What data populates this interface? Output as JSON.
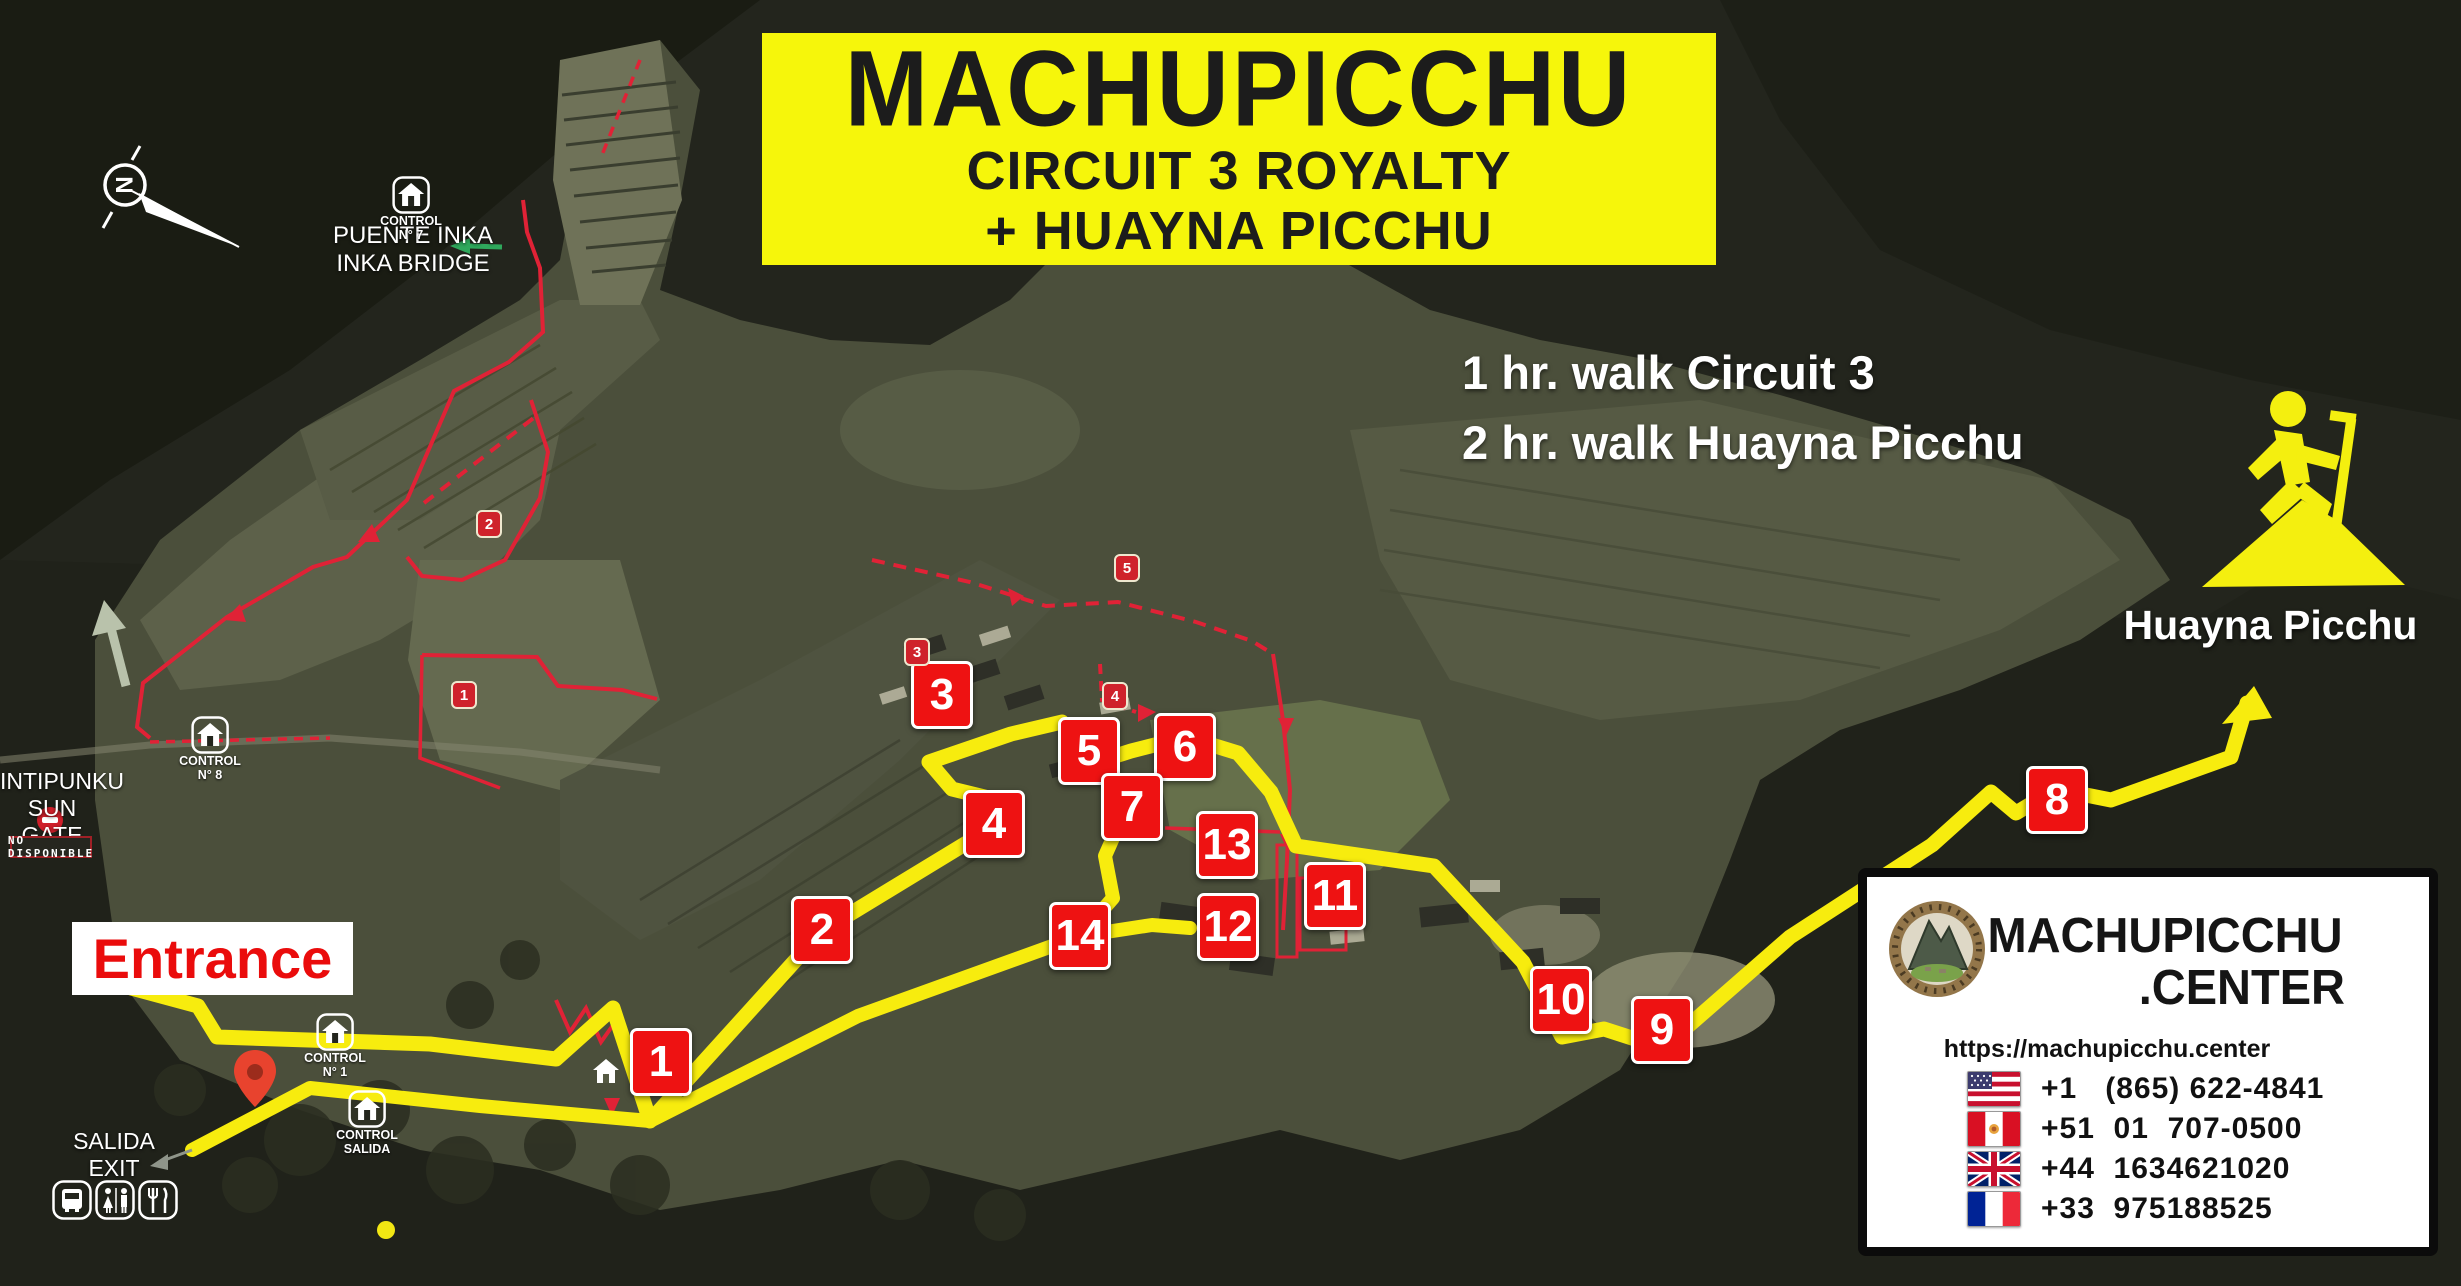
{
  "banner": {
    "title": "MACHUPICCHU",
    "subtitle1": "CIRCUIT 3 ROYALTY",
    "subtitle2": "+ HUAYNA PICCHU"
  },
  "walk_info": {
    "line1": "1 hr. walk Circuit 3",
    "line2": "2 hr. walk Huayna Picchu"
  },
  "huayna": {
    "label": "Huayna Picchu"
  },
  "entrance": {
    "label": "Entrance"
  },
  "exit_label": {
    "line1": "SALIDA",
    "line2": "EXIT"
  },
  "sun_gate": {
    "line1": "INTIPUNKU",
    "line2": "SUN GATE",
    "badge": "NO DISPONIBLE"
  },
  "inka_bridge": {
    "line1": "PUENTE INKA",
    "line2": "INKA BRIDGE"
  },
  "compass": {
    "letter": "N"
  },
  "controls": [
    {
      "id": "7",
      "line1": "CONTROL",
      "line2": "N° 7",
      "x": 411,
      "y": 176
    },
    {
      "id": "8",
      "line1": "CONTROL",
      "line2": "N° 8",
      "x": 210,
      "y": 716
    },
    {
      "id": "1",
      "line1": "CONTROL",
      "line2": "N° 1",
      "x": 335,
      "y": 1013
    },
    {
      "id": "salida",
      "line1": "CONTROL",
      "line2": "SALIDA",
      "x": 367,
      "y": 1090
    }
  ],
  "waypoints": [
    {
      "n": "1",
      "x": 661,
      "y": 1062
    },
    {
      "n": "2",
      "x": 822,
      "y": 930
    },
    {
      "n": "3",
      "x": 942,
      "y": 695
    },
    {
      "n": "4",
      "x": 994,
      "y": 824
    },
    {
      "n": "5",
      "x": 1089,
      "y": 751
    },
    {
      "n": "6",
      "x": 1185,
      "y": 747
    },
    {
      "n": "7",
      "x": 1132,
      "y": 807
    },
    {
      "n": "8",
      "x": 2057,
      "y": 800
    },
    {
      "n": "9",
      "x": 1662,
      "y": 1030
    },
    {
      "n": "10",
      "x": 1561,
      "y": 1000
    },
    {
      "n": "11",
      "x": 1335,
      "y": 896
    },
    {
      "n": "12",
      "x": 1228,
      "y": 927
    },
    {
      "n": "13",
      "x": 1227,
      "y": 845
    },
    {
      "n": "14",
      "x": 1080,
      "y": 936
    }
  ],
  "red_waypoints": [
    {
      "n": "1",
      "x": 464,
      "y": 695
    },
    {
      "n": "2",
      "x": 489,
      "y": 524
    },
    {
      "n": "3",
      "x": 917,
      "y": 652
    },
    {
      "n": "4",
      "x": 1115,
      "y": 696
    },
    {
      "n": "5",
      "x": 1127,
      "y": 568
    }
  ],
  "contact": {
    "brand_top": "MACHUPICCHU",
    "brand_bottom": ".CENTER",
    "url": "https://machupicchu.center",
    "phones": [
      {
        "country": "usa",
        "number": "+1   (865) 622-4841"
      },
      {
        "country": "peru",
        "number": "+51  01  707-0500"
      },
      {
        "country": "uk",
        "number": "+44  1634621020"
      },
      {
        "country": "france",
        "number": "+33  975188525"
      }
    ]
  },
  "colors": {
    "banner_bg": "#f6f60b",
    "marker_red": "#ee1212",
    "route_yellow": "#f7ec0e",
    "red_path": "#e02236"
  }
}
